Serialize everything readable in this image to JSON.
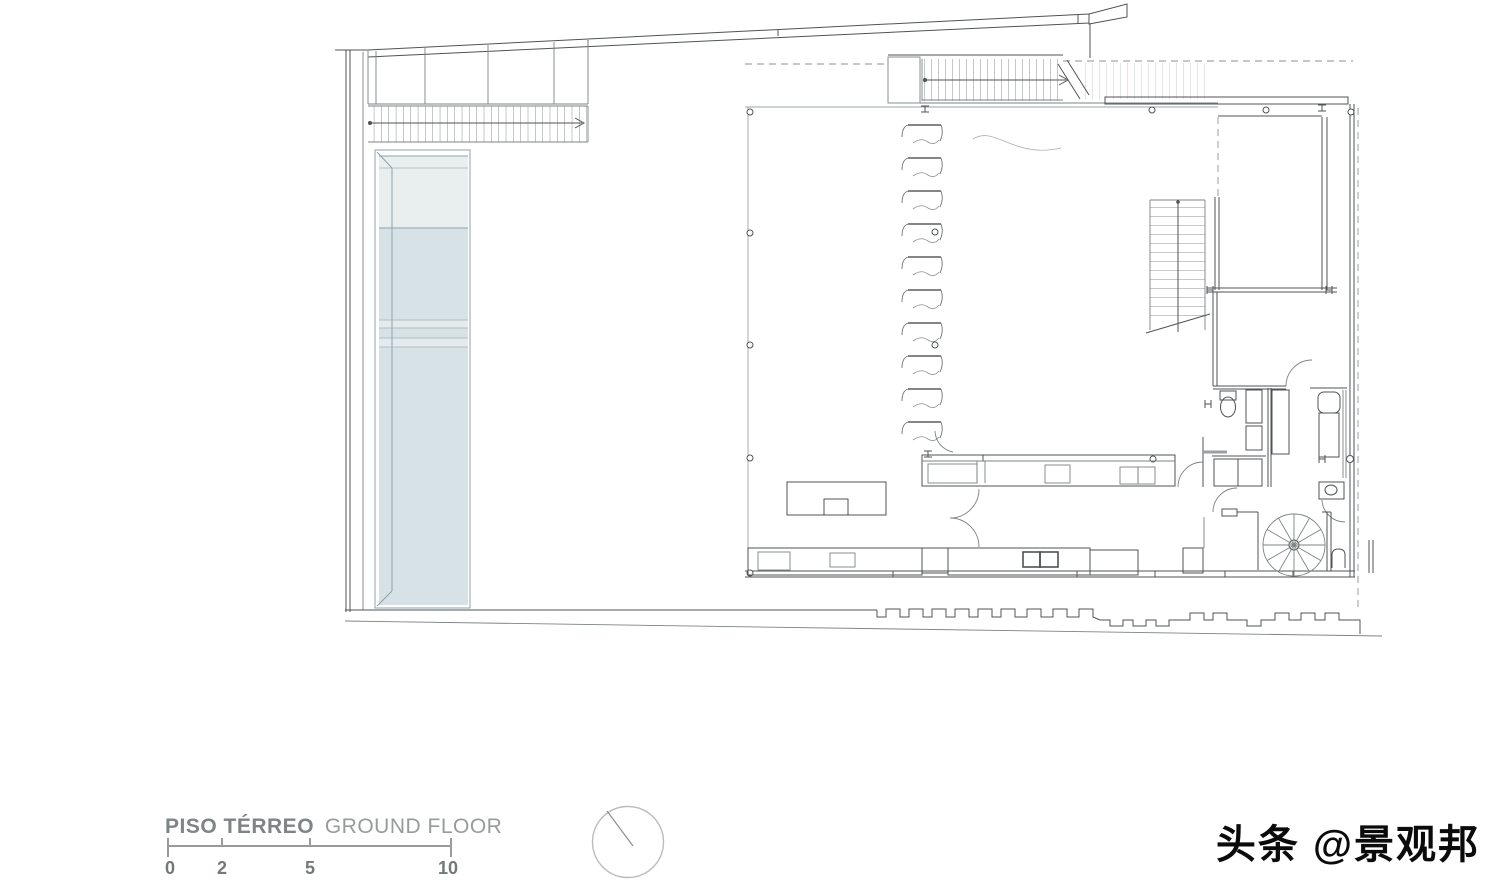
{
  "plan": {
    "title_primary": "PISO TÉRREO",
    "title_secondary": "GROUND FLOOR",
    "scale_bar": {
      "ticks": [
        "0",
        "2",
        "5",
        "10"
      ]
    }
  },
  "watermark": {
    "text": "头条 @景观邦"
  },
  "icons": [
    "north-indicator-icon",
    "stair-direction-arrow-icon",
    "column-marker-icon",
    "steel-beam-icon",
    "toilet-icon",
    "washer-icon",
    "spiral-stair-icon"
  ],
  "colors": {
    "ink": "#4f5354",
    "mid": "#7d8384",
    "light": "#a9b1b1",
    "glass": "#9aa4a4",
    "dash": "#8c9292",
    "pool-border": "#8fa3aa",
    "pool-upper": "#e9efef",
    "pool-lower": "#d7e2e7",
    "pool-band": "#e3ebee",
    "title-text": "#7f8486",
    "scale-text": "#737879",
    "watermark": "#0b0b0b",
    "north-ring": "#b9bdbd"
  }
}
